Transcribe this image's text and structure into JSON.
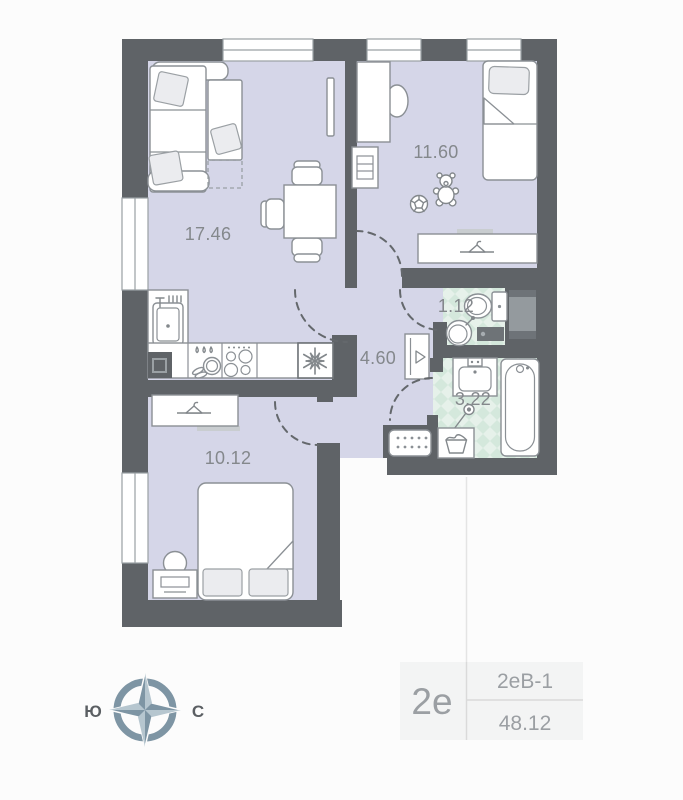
{
  "plan": {
    "rooms": [
      {
        "name": "living-room",
        "area_label": "17.46"
      },
      {
        "name": "child-bedroom",
        "area_label": "11.60"
      },
      {
        "name": "bedroom",
        "area_label": "10.12"
      },
      {
        "name": "hallway",
        "area_label": "4.60"
      },
      {
        "name": "wc",
        "area_label": "1.12"
      },
      {
        "name": "bathroom",
        "area_label": "3.22"
      }
    ],
    "colors": {
      "walls": "#5f6367",
      "floor": "#d5d6e8",
      "tile_background": "#e6f1ea",
      "tile_check": "#d4e8dc",
      "furniture_stroke": "#8b9095",
      "label_text": "#84888c"
    }
  },
  "compass": {
    "south_label": "Ю",
    "north_label": "С",
    "color": "#7e95a4"
  },
  "card": {
    "flat_type": "2е",
    "flat_code": "2еВ-1",
    "total_area": "48.12"
  }
}
